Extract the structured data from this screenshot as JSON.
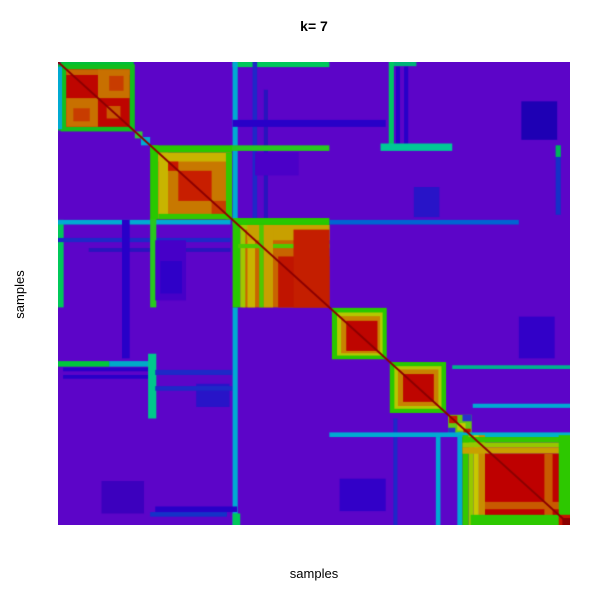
{
  "figure": {
    "kind": "consensus-matrix-heatmap",
    "background": "#ffffff"
  },
  "chart_data": {
    "type": "heatmap",
    "title": "k= 7",
    "xlabel": "samples",
    "ylabel": "samples",
    "k": 7,
    "legend": "none",
    "axes": "no ticks, no tick labels; matrix fills plot region",
    "value_scale": "consensus 0 (purple) to 1 (red), rainbow-like palette",
    "palette": {
      "low": "#5C05C8",
      "blue": "#2800C8",
      "cyan": "#00AAD2",
      "green": "#28C800",
      "yellow": "#C8C800",
      "orange": "#C87800",
      "high": "#BE0500",
      "diagonal": "#8C0000"
    },
    "plot_region": {
      "left": 58,
      "top": 62,
      "width": 512,
      "height": 463
    },
    "background": "#5C05C8",
    "clusters": [
      {
        "id": 1,
        "start": 0.008,
        "end": 0.148,
        "core_color": "#BE0500",
        "note": "red/orange checker block with green ring"
      },
      {
        "id": 2,
        "start": 0.18,
        "end": 0.34,
        "core_color": "#C87800",
        "note": "orange block, yellow stripes, red center"
      },
      {
        "id": 3,
        "start": 0.341,
        "end": 0.53,
        "core_color": "#C86400",
        "note": "largest striped block, solid red lower-right"
      },
      {
        "id": 4,
        "start": 0.535,
        "end": 0.642,
        "core_color": "#BE0500",
        "note": "red core, orange+yellow+green rings"
      },
      {
        "id": 5,
        "start": 0.648,
        "end": 0.758,
        "core_color": "#BE0500",
        "note": "red core, orange+yellow+green rings"
      },
      {
        "id": 6,
        "start": 0.762,
        "end": 0.806,
        "core_color": "#C81400",
        "note": "tiny mixed block"
      },
      {
        "id": 7,
        "start": 0.79,
        "end": 1.0,
        "core_color": "#BE0000",
        "note": "large solid red block with rainbow border"
      }
    ],
    "rects": [
      [
        0.005,
        0.0,
        0.148,
        0.01,
        "#00BE3C"
      ],
      [
        0.0,
        0.005,
        0.01,
        0.148,
        "#00BE3C"
      ],
      [
        0.341,
        0.0,
        0.53,
        0.011,
        "#00C85A"
      ],
      [
        0.0,
        0.341,
        0.011,
        0.53,
        "#00C85A"
      ],
      [
        0.648,
        0.0,
        0.7,
        0.009,
        "#00B478"
      ],
      [
        0.341,
        0.0,
        0.351,
        0.337,
        "#00AAD2"
      ],
      [
        0.0,
        0.341,
        0.337,
        0.351,
        "#00AAD2"
      ],
      [
        0.341,
        0.53,
        0.351,
        1.0,
        "#00AAD2"
      ],
      [
        0.53,
        0.341,
        0.9,
        0.351,
        "#0064D2"
      ],
      [
        0.38,
        0.0,
        0.389,
        0.337,
        "#1E28C8"
      ],
      [
        0.0,
        0.38,
        0.337,
        0.389,
        "#1E28C8"
      ],
      [
        0.402,
        0.06,
        0.41,
        0.337,
        "#2814BE"
      ],
      [
        0.06,
        0.402,
        0.337,
        0.41,
        "#2814BE"
      ],
      [
        0.341,
        0.125,
        0.64,
        0.14,
        "#2800C8"
      ],
      [
        0.125,
        0.341,
        0.14,
        0.64,
        "#2800C8"
      ],
      [
        0.646,
        0.0,
        0.656,
        0.18,
        "#00C864"
      ],
      [
        0.0,
        0.646,
        0.1,
        0.658,
        "#00C83C"
      ],
      [
        0.1,
        0.646,
        0.185,
        0.658,
        "#00AAC8"
      ],
      [
        0.66,
        0.01,
        0.668,
        0.18,
        "#2800C8"
      ],
      [
        0.676,
        0.01,
        0.684,
        0.18,
        "#2800C8"
      ],
      [
        0.01,
        0.66,
        0.18,
        0.668,
        "#2800C8"
      ],
      [
        0.01,
        0.676,
        0.18,
        0.684,
        "#2800C8"
      ],
      [
        0.63,
        0.176,
        0.77,
        0.192,
        "#00C896"
      ],
      [
        0.176,
        0.63,
        0.192,
        0.77,
        "#00C88C"
      ],
      [
        0.337,
        0.18,
        0.53,
        0.192,
        "#28C81E"
      ],
      [
        0.18,
        0.337,
        0.192,
        0.53,
        "#28C81E"
      ],
      [
        0.905,
        0.085,
        0.975,
        0.168,
        "#1E00B4"
      ],
      [
        0.085,
        0.905,
        0.168,
        0.975,
        "#3C00BE"
      ],
      [
        0.972,
        0.18,
        0.982,
        0.33,
        "#1432C8"
      ],
      [
        0.972,
        0.18,
        0.982,
        0.205,
        "#00B45A"
      ],
      [
        0.18,
        0.972,
        0.33,
        0.982,
        "#1432C8"
      ],
      [
        0.19,
        0.385,
        0.25,
        0.515,
        "#4600C8"
      ],
      [
        0.2,
        0.43,
        0.242,
        0.5,
        "#2F00C8"
      ],
      [
        0.385,
        0.195,
        0.47,
        0.245,
        "#4B00C8"
      ],
      [
        0.27,
        0.695,
        0.335,
        0.745,
        "#2814C8"
      ],
      [
        0.695,
        0.27,
        0.745,
        0.335,
        "#2814C8"
      ],
      [
        0.19,
        0.665,
        0.34,
        0.676,
        "#1E28C8"
      ],
      [
        0.19,
        0.7,
        0.34,
        0.71,
        "#1E28C8"
      ],
      [
        0.738,
        0.81,
        0.747,
        1.0,
        "#00AAD2"
      ],
      [
        0.81,
        0.738,
        1.0,
        0.747,
        "#00AAD2"
      ],
      [
        0.655,
        0.77,
        0.663,
        1.0,
        "#1E28C8"
      ],
      [
        0.77,
        0.655,
        1.0,
        0.663,
        "#00B48C"
      ],
      [
        0.55,
        0.9,
        0.64,
        0.97,
        "#3200C8"
      ],
      [
        0.9,
        0.55,
        0.97,
        0.64,
        "#3200C8"
      ],
      [
        0.19,
        0.96,
        0.35,
        0.972,
        "#2800C8"
      ],
      [
        0.341,
        0.975,
        0.356,
        1.0,
        "#00C85A"
      ],
      [
        0.005,
        0.005,
        0.15,
        0.15,
        "#12BE1E"
      ],
      [
        0.0,
        0.01,
        0.008,
        0.145,
        "#00AAD2"
      ],
      [
        0.016,
        0.016,
        0.14,
        0.14,
        "#BE0500"
      ],
      [
        0.016,
        0.016,
        0.14,
        0.028,
        "#C86400"
      ],
      [
        0.078,
        0.016,
        0.14,
        0.078,
        "#C87000"
      ],
      [
        0.016,
        0.078,
        0.078,
        0.14,
        "#C87000"
      ],
      [
        0.1,
        0.03,
        0.128,
        0.062,
        "#C83C00"
      ],
      [
        0.03,
        0.1,
        0.062,
        0.128,
        "#C83C00"
      ],
      [
        0.095,
        0.095,
        0.122,
        0.122,
        "#C85A00"
      ],
      [
        0.15,
        0.15,
        0.165,
        0.165,
        "#32C83C"
      ],
      [
        0.162,
        0.162,
        0.18,
        0.18,
        "#00AAD2"
      ],
      [
        0.18,
        0.18,
        0.196,
        0.34,
        "#28C800"
      ],
      [
        0.18,
        0.18,
        0.34,
        0.196,
        "#28C800"
      ],
      [
        0.196,
        0.196,
        0.338,
        0.338,
        "#C87800"
      ],
      [
        0.196,
        0.196,
        0.215,
        0.338,
        "#C8B400"
      ],
      [
        0.196,
        0.196,
        0.338,
        0.215,
        "#C8B400"
      ],
      [
        0.235,
        0.235,
        0.3,
        0.3,
        "#C81E00"
      ],
      [
        0.3,
        0.3,
        0.335,
        0.335,
        "#C83C00"
      ],
      [
        0.215,
        0.215,
        0.235,
        0.235,
        "#C81400"
      ],
      [
        0.328,
        0.196,
        0.34,
        0.34,
        "#32C800"
      ],
      [
        0.196,
        0.328,
        0.34,
        0.34,
        "#32C800"
      ],
      [
        0.36,
        0.36,
        0.53,
        0.53,
        "#C86400"
      ],
      [
        0.341,
        0.337,
        0.356,
        0.53,
        "#28C800"
      ],
      [
        0.341,
        0.337,
        0.53,
        0.352,
        "#28C800"
      ],
      [
        0.356,
        0.352,
        0.366,
        0.53,
        "#A0C800"
      ],
      [
        0.356,
        0.352,
        0.53,
        0.362,
        "#A0C800"
      ],
      [
        0.37,
        0.352,
        0.385,
        0.53,
        "#C8B400"
      ],
      [
        0.37,
        0.352,
        0.53,
        0.385,
        "#C8A000"
      ],
      [
        0.393,
        0.352,
        0.402,
        0.53,
        "#50C800"
      ],
      [
        0.352,
        0.393,
        0.53,
        0.402,
        "#50C800"
      ],
      [
        0.402,
        0.352,
        0.42,
        0.53,
        "#C8A000"
      ],
      [
        0.43,
        0.42,
        0.53,
        0.53,
        "#C01400"
      ],
      [
        0.46,
        0.362,
        0.53,
        0.53,
        "#C41E00"
      ],
      [
        0.535,
        0.531,
        0.642,
        0.642,
        "#28C800"
      ],
      [
        0.545,
        0.541,
        0.634,
        0.634,
        "#B4C800"
      ],
      [
        0.553,
        0.549,
        0.629,
        0.629,
        "#C88200"
      ],
      [
        0.563,
        0.559,
        0.624,
        0.624,
        "#BE0500"
      ],
      [
        0.648,
        0.648,
        0.758,
        0.758,
        "#28C800"
      ],
      [
        0.657,
        0.657,
        0.749,
        0.749,
        "#B4C800"
      ],
      [
        0.664,
        0.664,
        0.743,
        0.743,
        "#C88200"
      ],
      [
        0.674,
        0.674,
        0.734,
        0.734,
        "#BE0500"
      ],
      [
        0.762,
        0.762,
        0.808,
        0.808,
        "#64C814"
      ],
      [
        0.762,
        0.79,
        0.776,
        0.808,
        "#2832C8"
      ],
      [
        0.79,
        0.762,
        0.808,
        0.776,
        "#2832C8"
      ],
      [
        0.764,
        0.764,
        0.78,
        0.78,
        "#C81400"
      ],
      [
        0.78,
        0.78,
        0.796,
        0.796,
        "#C8C800"
      ],
      [
        0.792,
        0.792,
        0.806,
        0.806,
        "#C81400"
      ],
      [
        0.53,
        0.8,
        0.79,
        0.81,
        "#00AAD2"
      ],
      [
        0.78,
        0.8,
        1.0,
        0.81,
        "#00B4C8"
      ],
      [
        0.78,
        0.806,
        0.79,
        1.0,
        "#00AAD2"
      ],
      [
        0.79,
        0.806,
        0.802,
        1.0,
        "#32C800"
      ],
      [
        0.802,
        0.806,
        0.812,
        1.0,
        "#96C800"
      ],
      [
        0.812,
        0.806,
        0.822,
        1.0,
        "#C8C800"
      ],
      [
        0.822,
        0.806,
        0.834,
        1.0,
        "#C88C00"
      ],
      [
        0.79,
        0.81,
        1.0,
        0.822,
        "#32C800"
      ],
      [
        0.79,
        0.822,
        1.0,
        0.832,
        "#96C800"
      ],
      [
        0.79,
        0.832,
        1.0,
        0.846,
        "#C8A000"
      ],
      [
        0.834,
        0.846,
        1.0,
        1.0,
        "#BE0000"
      ],
      [
        0.834,
        0.95,
        1.0,
        0.966,
        "#C85A00"
      ],
      [
        0.95,
        0.846,
        0.966,
        1.0,
        "#C85A00"
      ],
      [
        0.978,
        0.806,
        1.0,
        1.0,
        "#2DC800"
      ],
      [
        0.806,
        0.978,
        1.0,
        1.0,
        "#2DC800"
      ],
      [
        0.978,
        0.978,
        1.0,
        1.0,
        "#C81400"
      ],
      [
        0.985,
        0.985,
        1.0,
        1.0,
        "#8C0000"
      ]
    ],
    "diagonal": {
      "color": "#8C0000",
      "width": 2
    }
  }
}
